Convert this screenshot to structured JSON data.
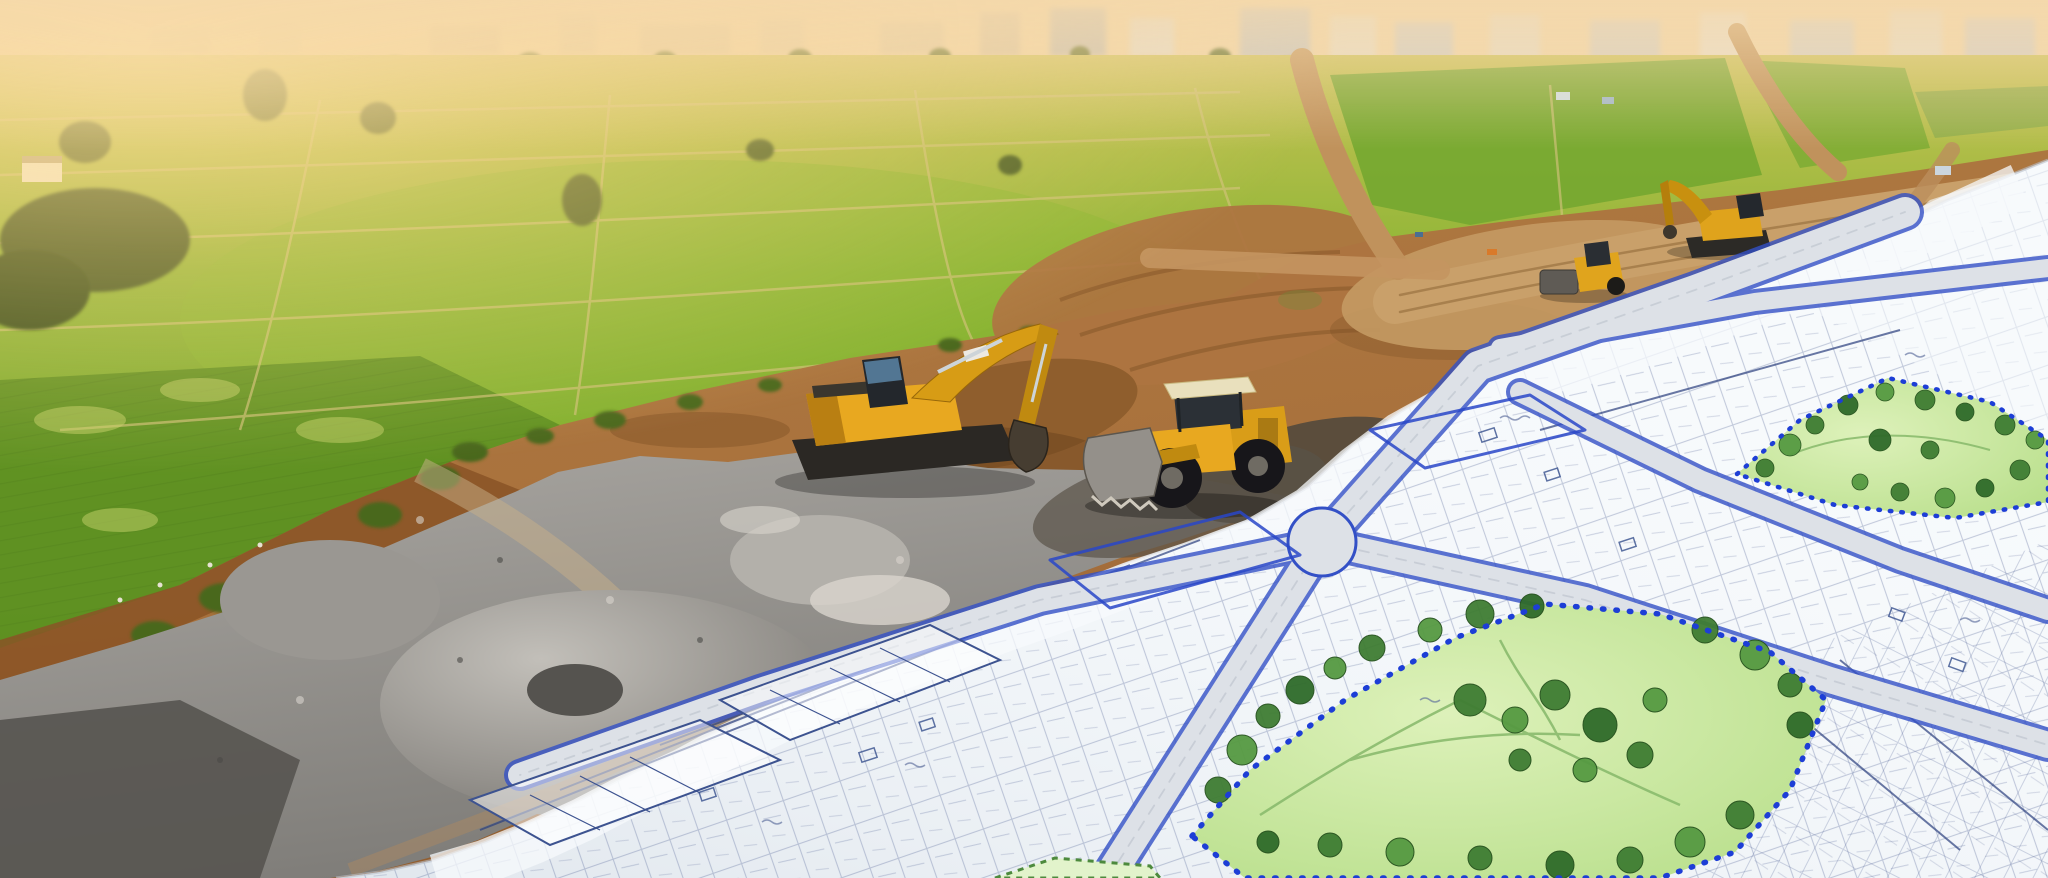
{
  "scene": {
    "type": "aerial-photo-composite",
    "description": "Aerial photograph of green farmland at golden hour that transitions into an architect's housing-layout blueprint; earthmoving machines work along the boundary between the real fields and the drawn site plan.",
    "regions": [
      {
        "id": "sky-haze",
        "label": "hazy sunset sky with distant town skyline"
      },
      {
        "id": "farmland",
        "label": "green crop fields divided by paths and tree lines"
      },
      {
        "id": "earthworks",
        "label": "cleared brown earth with graded dirt roads"
      },
      {
        "id": "gravel-stockpiles",
        "label": "grey gravel and rubble stockpiles"
      },
      {
        "id": "site-plan",
        "label": "white blueprint with plotted streets, housing blocks and parks"
      }
    ]
  },
  "machines": [
    {
      "id": "excavator-main",
      "label": "tracked excavator digging at the field edge"
    },
    {
      "id": "wheel-loader",
      "label": "wheel loader on graded pad"
    },
    {
      "id": "excavator-distant",
      "label": "second excavator working near town road"
    },
    {
      "id": "road-roller",
      "label": "compact roller beside dirt road"
    }
  ],
  "site_plan": {
    "parks": [
      {
        "id": "central-park",
        "label": "large landscaped park with sketched trees"
      },
      {
        "id": "northeast-park",
        "label": "smaller square park with sketched trees"
      }
    ],
    "streets_drawn": 6,
    "boundary_style": "blue beaded dotted line around parks and blocks"
  },
  "palette": {
    "sky_haze": "#f2d9ae",
    "sun_glow": "#ffe2a2",
    "field_light": "#c9c356",
    "field_mid": "#8db535",
    "field_dark": "#5d8f21",
    "earth": "#a8713c",
    "earth_dark": "#8a5426",
    "road_dirt": "#c9a06a",
    "gravel_mid": "#9a9792",
    "paper": "#f7fafc",
    "plan_line": "#4a5c92",
    "street_fill": "#dde1e7",
    "street_edge": "#3350c6",
    "boundary_blue": "#1d3ed6",
    "park_fill": "#cdeba6",
    "park_tree": "#3f7d33",
    "machine_yellow": "#e8a820",
    "machine_dark": "#2b2824"
  }
}
